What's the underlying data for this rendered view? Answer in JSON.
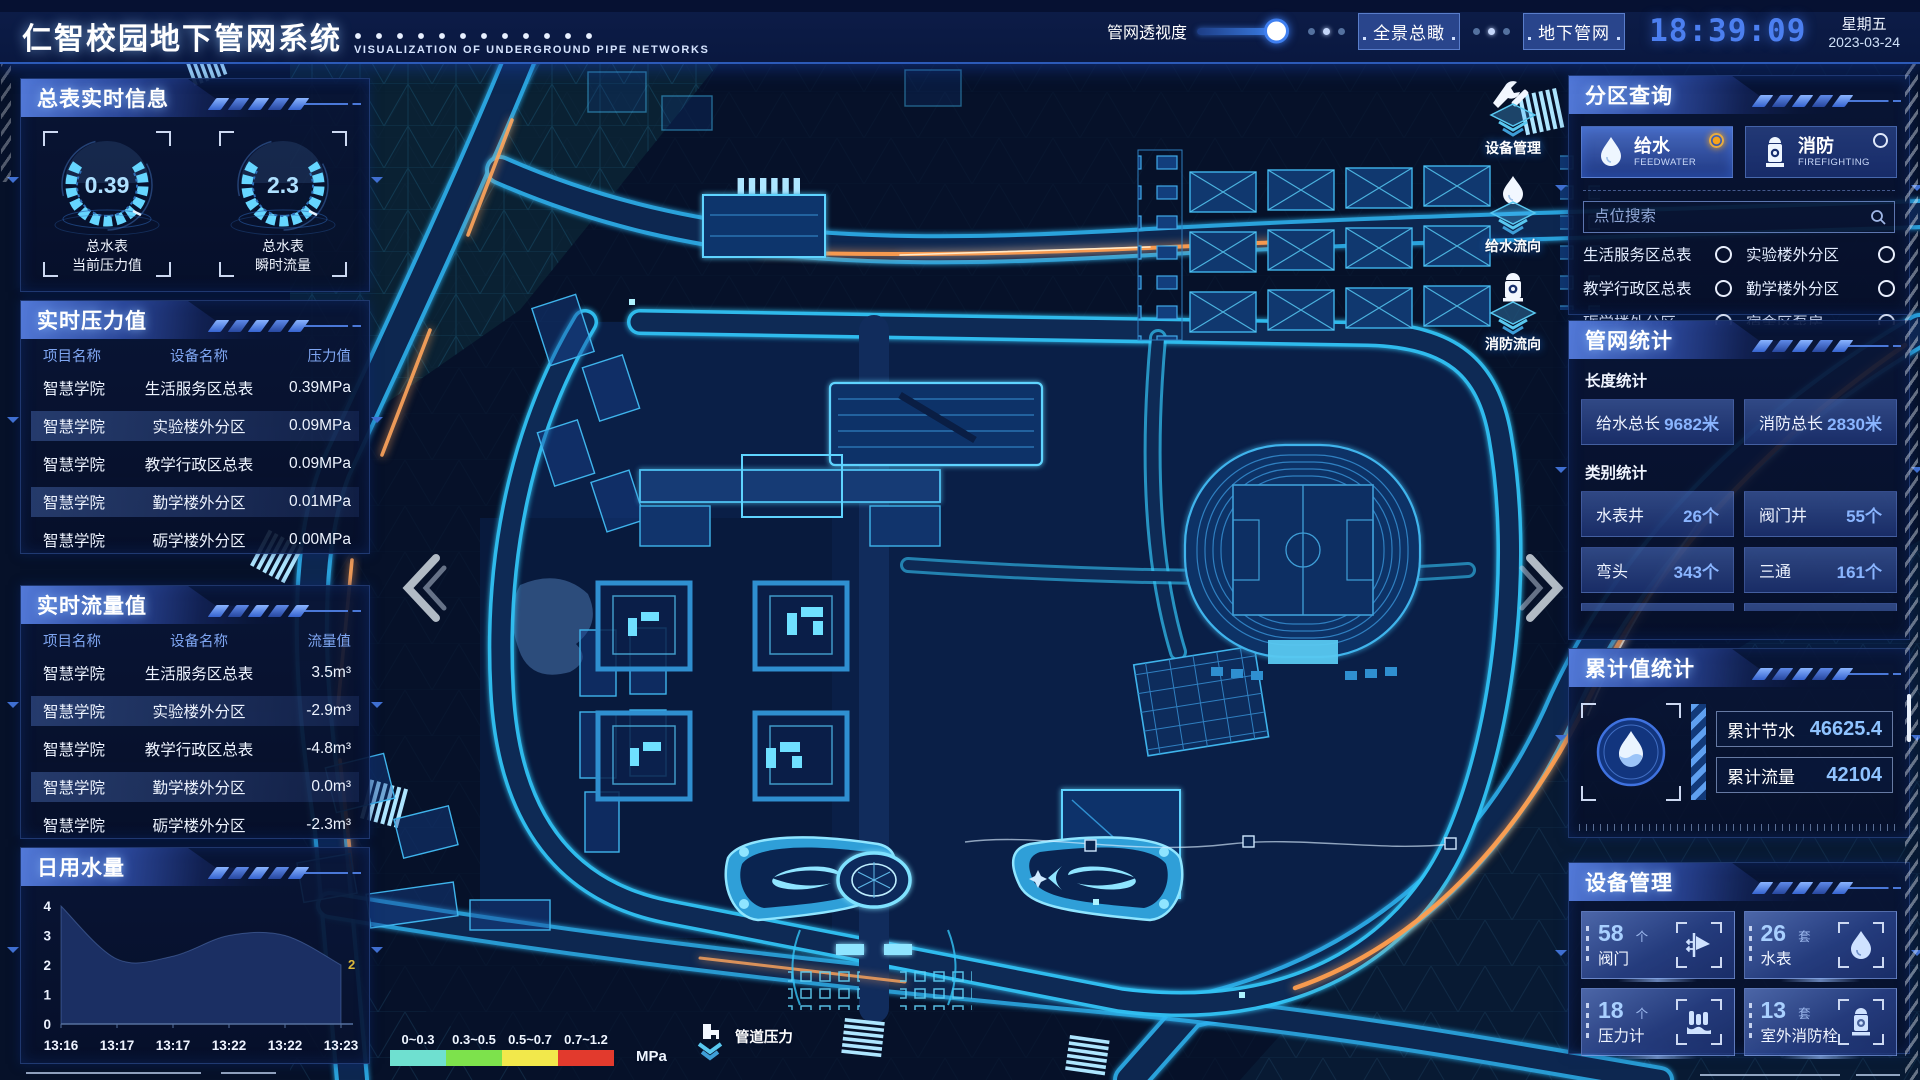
{
  "header": {
    "title": "仁智校园地下管网系统",
    "subtitle": "VISUALIZATION OF UNDERGROUND PIPE NETWORKS",
    "slider_label": "管网透视度",
    "btn_overview": "全景总瞰",
    "btn_underground": "地下管网",
    "time": "18:39:09",
    "weekday": "星期五",
    "date": "2023-03-24"
  },
  "left": {
    "meter_panel": {
      "title": "总表实时信息",
      "gauges": [
        {
          "value": "0.39",
          "line1": "总水表",
          "line2": "当前压力值"
        },
        {
          "value": "2.3",
          "line1": "总水表",
          "line2": "瞬时流量"
        }
      ]
    },
    "pressure_panel": {
      "title": "实时压力值",
      "headers": [
        "项目名称",
        "设备名称",
        "压力值"
      ],
      "rows": [
        [
          "智慧学院",
          "生活服务区总表",
          "0.39MPa"
        ],
        [
          "智慧学院",
          "实验楼外分区",
          "0.09MPa"
        ],
        [
          "智慧学院",
          "教学行政区总表",
          "0.09MPa"
        ],
        [
          "智慧学院",
          "勤学楼外分区",
          "0.01MPa"
        ],
        [
          "智慧学院",
          "砺学楼外分区",
          "0.00MPa"
        ]
      ]
    },
    "flow_panel": {
      "title": "实时流量值",
      "headers": [
        "项目名称",
        "设备名称",
        "流量值"
      ],
      "rows": [
        [
          "智慧学院",
          "生活服务区总表",
          "3.5m³"
        ],
        [
          "智慧学院",
          "实验楼外分区",
          "-2.9m³"
        ],
        [
          "智慧学院",
          "教学行政区总表",
          "-4.8m³"
        ],
        [
          "智慧学院",
          "勤学楼外分区",
          "0.0m³"
        ],
        [
          "智慧学院",
          "砺学楼外分区",
          "-2.3m³"
        ]
      ]
    },
    "daily_panel": {
      "title": "日用水量"
    }
  },
  "chart_data": {
    "type": "area",
    "title": "日用水量",
    "x": [
      "13:16",
      "13:17",
      "13:17",
      "13:22",
      "13:22",
      "13:23"
    ],
    "values": [
      4,
      2.2,
      2.3,
      3,
      3,
      2
    ],
    "yticks": [
      0,
      1,
      2,
      3,
      4
    ],
    "ylim": [
      0,
      4
    ],
    "end_label": "2",
    "grid": false,
    "legend_position": "none",
    "area_color": "#1b2f63",
    "end_label_color": "#d9b83c"
  },
  "right": {
    "zone_panel": {
      "title": "分区查询",
      "tabs": [
        {
          "label": "给水",
          "sub": "FEEDWATER",
          "active": true
        },
        {
          "label": "消防",
          "sub": "FIREFIGHTING",
          "active": false
        }
      ],
      "search_placeholder": "点位搜索",
      "items": [
        "生活服务区总表",
        "实验楼外分区",
        "教学行政区总表",
        "勤学楼外分区",
        "砺学楼外分区",
        "宿舍区泵房"
      ]
    },
    "network_panel": {
      "title": "管网统计",
      "length_label": "长度统计",
      "length_stats": [
        {
          "label": "给水总长",
          "value": "9682米"
        },
        {
          "label": "消防总长",
          "value": "2830米"
        }
      ],
      "category_label": "类别统计",
      "category_stats": [
        {
          "label": "水表井",
          "value": "26个"
        },
        {
          "label": "阀门井",
          "value": "55个"
        },
        {
          "label": "弯头",
          "value": "343个"
        },
        {
          "label": "三通",
          "value": "161个"
        }
      ]
    },
    "total_panel": {
      "title": "累计值统计",
      "rows": [
        {
          "label": "累计节水",
          "value": "46625.4"
        },
        {
          "label": "累计流量",
          "value": "42104"
        }
      ]
    },
    "device_panel": {
      "title": "设备管理",
      "cards": [
        {
          "count": "58",
          "unit": "个",
          "label": "阀门",
          "icon": "valve-icon"
        },
        {
          "count": "26",
          "unit": "套",
          "label": "水表",
          "icon": "water-meter-icon"
        },
        {
          "count": "18",
          "unit": "个",
          "label": "压力计",
          "icon": "pressure-gauge-icon"
        },
        {
          "count": "13",
          "unit": "套",
          "label": "室外消防栓",
          "icon": "hydrant-icon"
        }
      ]
    }
  },
  "map_overlay": {
    "tools": [
      {
        "label": "设备管理",
        "icon": "tools-icon"
      },
      {
        "label": "给水流向",
        "icon": "water-drop-icon"
      },
      {
        "label": "消防流向",
        "icon": "hydrant-icon"
      }
    ],
    "legend": {
      "ranges": [
        "0~0.3",
        "0.3~0.5",
        "0.5~0.7",
        "0.7~1.2"
      ],
      "colors": [
        "#6fe0d0",
        "#7de24c",
        "#f2e84b",
        "#e23a2d"
      ],
      "unit": "MPa",
      "label": "管道压力"
    }
  }
}
